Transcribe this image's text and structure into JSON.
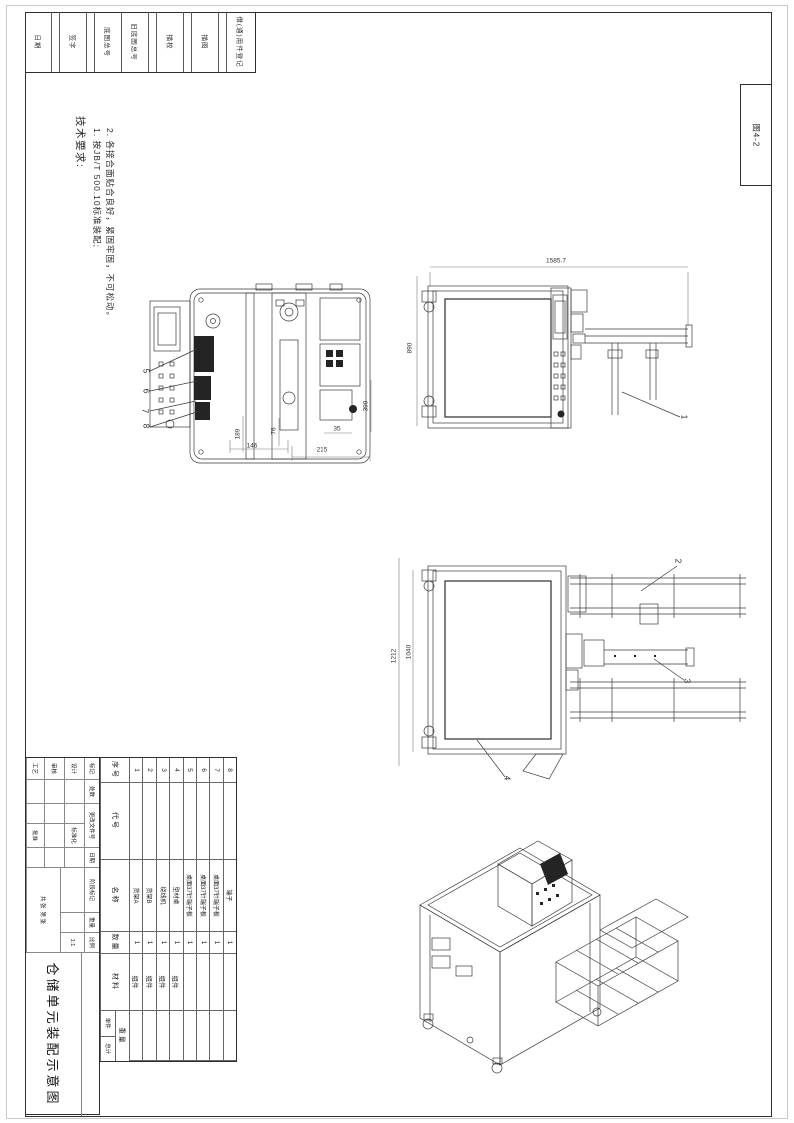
{
  "ink": "#2e2e2e",
  "figure_label": "图4-2",
  "margin_strip": {
    "labels": [
      "日期",
      "签字",
      "底图总号",
      "旧底图总号",
      "描校",
      "描图",
      "借(通)用件登记"
    ]
  },
  "tech_requirements": {
    "title": "技术要求:",
    "items": [
      "1. 按JB/T 500.10标准装配;",
      "2. 各接合面贴合良好，紧固牢固，不可松动。"
    ]
  },
  "dimensions": {
    "view_top": {
      "d146": "146",
      "d215": "215",
      "d35": "35",
      "d189": "189",
      "d76": "76",
      "d399": "399"
    },
    "view_side_b": {
      "width": "1585.7",
      "height": "890"
    },
    "view_side_c": {
      "inner": "1040",
      "outer": "1212"
    }
  },
  "balloons": [
    "1",
    "2",
    "3",
    "4",
    "5",
    "6",
    "7",
    "8"
  ],
  "bom": {
    "headers": {
      "index": "序号",
      "code": "代号",
      "name": "名称",
      "qty": "数量",
      "material": "材料",
      "weight": "重量",
      "unit": "单件",
      "total": "总计"
    },
    "rows": [
      {
        "index": "1",
        "code": "",
        "name": "货架A",
        "qty": "1",
        "material": "组件"
      },
      {
        "index": "2",
        "code": "",
        "name": "货架B",
        "qty": "1",
        "material": "组件"
      },
      {
        "index": "3",
        "code": "",
        "name": "绕线机",
        "qty": "1",
        "material": "组件"
      },
      {
        "index": "4",
        "code": "",
        "name": "型材桌",
        "qty": "1",
        "material": "组件"
      },
      {
        "index": "5",
        "code": "",
        "name": "桌面37针端子板",
        "qty": "1",
        "material": ""
      },
      {
        "index": "6",
        "code": "",
        "name": "桌面37针端子板",
        "qty": "1",
        "material": ""
      },
      {
        "index": "7",
        "code": "",
        "name": "桌面37针端子板",
        "qty": "1",
        "material": ""
      },
      {
        "index": "8",
        "code": "",
        "name": "端子",
        "qty": "1",
        "material": ""
      }
    ]
  },
  "title_block": {
    "revision_headers": [
      "标记",
      "处数",
      "更改文件号",
      "签字",
      "日期"
    ],
    "design_label": "设计",
    "check_label": "审核",
    "process_label": "工艺",
    "standardization_label": "标准化",
    "approve_label": "批准",
    "stage_label": "阶段标记",
    "weight_label": "重量",
    "scale_label": "比例",
    "scale_value": "1:1",
    "sheet_total_label": "共 张",
    "sheet_no_label": "第 张",
    "title": "仓储单元装配示意图"
  }
}
